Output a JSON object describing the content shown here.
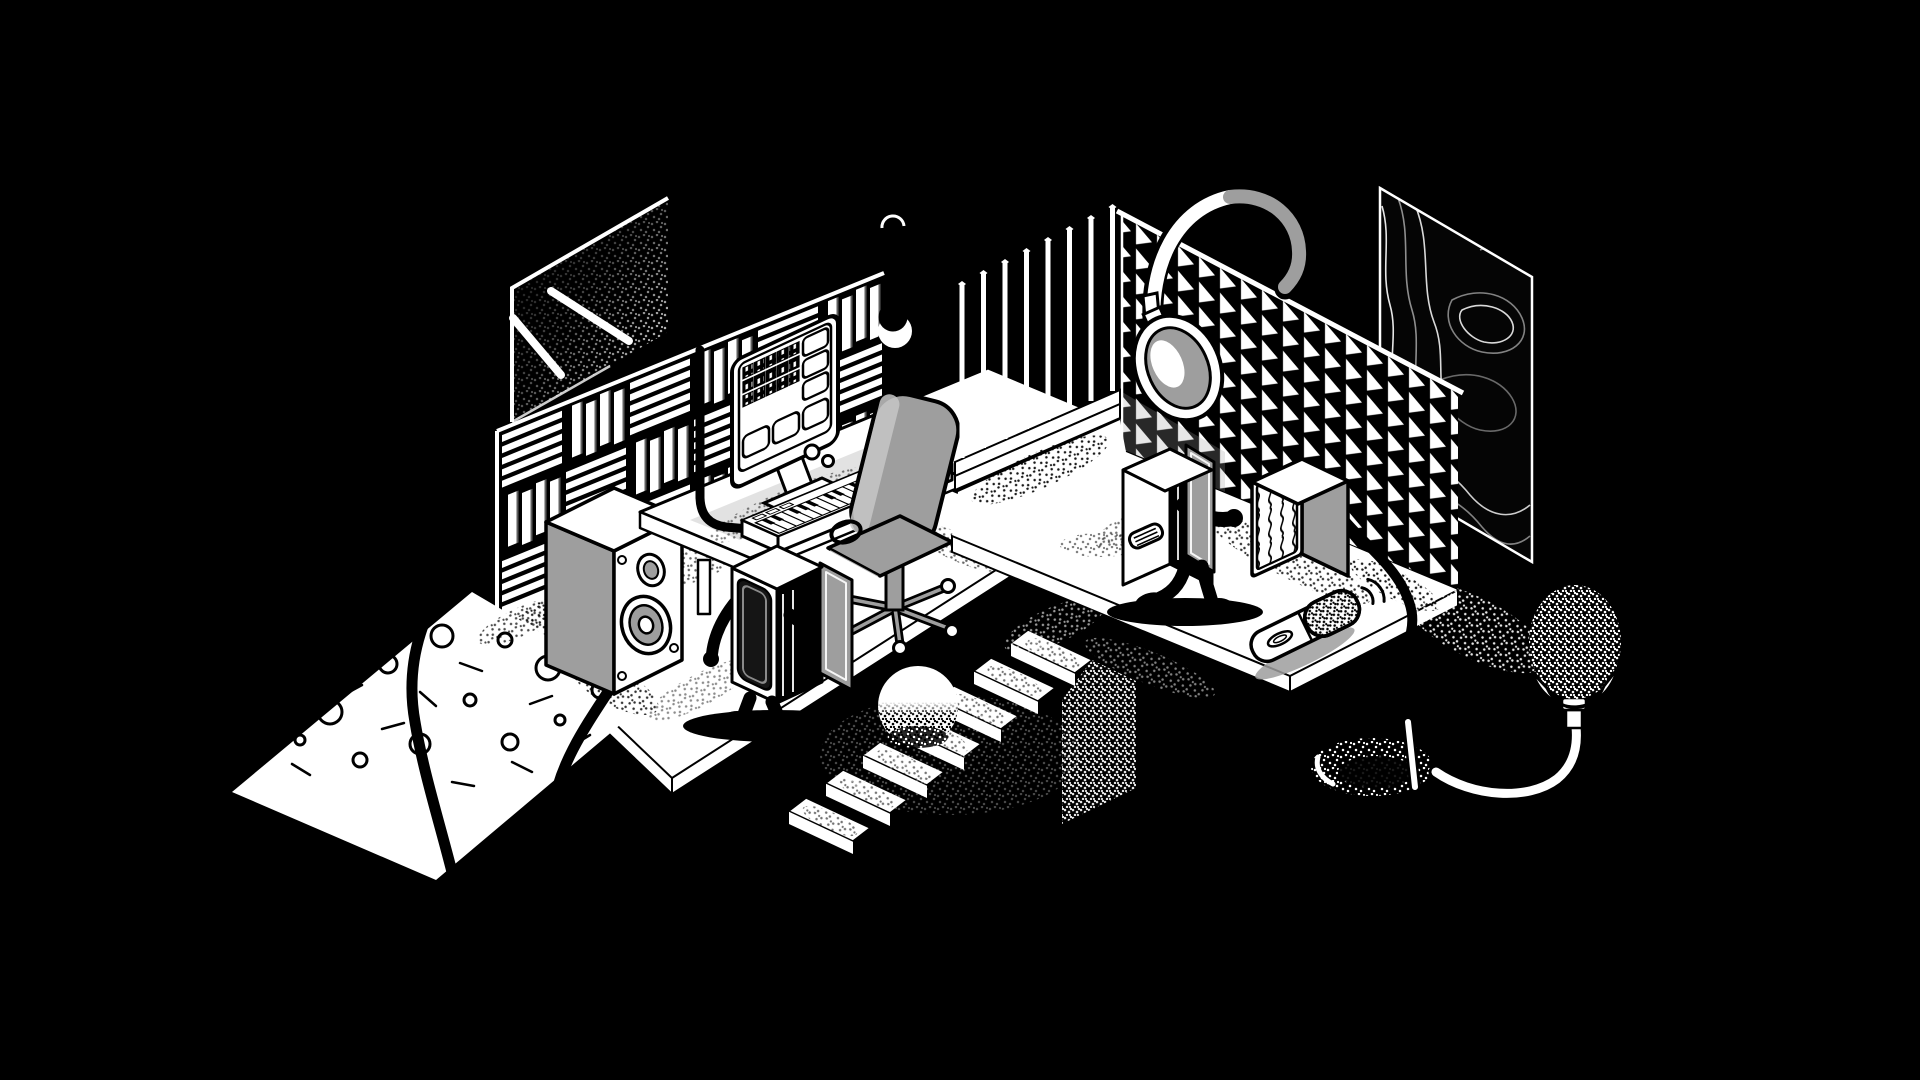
{
  "scene": {
    "description": "Monochrome isometric illustration of a two-room music studio: on the left a mixing room with a window, slatted acoustic wall, desk with computer monitor showing a DAW session, MIDI keyboard, office chair, a large studio monitor speaker and a walking cabinet character; between the rooms a hanging eclipse orb and a staircase with a ball; on the right a vocal booth with vertical rod diffuser, triangular acoustic foam wall, hanging headphones, a topographic art panel, a walking fridge character, a bass-trap cube, a handheld microphone, and a pop-filter microphone on a gooseneck rising from a hole in the floor.",
    "style": "black and white isometric line art with stipple shading"
  },
  "palette": {
    "background": "#000000",
    "ink": "#000000",
    "paper": "#ffffff",
    "gray": "#9e9e9e",
    "gray_light": "#c6c6c6"
  },
  "objects": [
    {
      "id": "window",
      "kind": "window with light beams"
    },
    {
      "id": "slat-acoustic-wall",
      "kind": "acoustic slat wall"
    },
    {
      "id": "pendant-orb",
      "kind": "eclipse orb lamp"
    },
    {
      "id": "desk",
      "kind": "studio desk"
    },
    {
      "id": "monitor",
      "kind": "computer monitor with session blocks"
    },
    {
      "id": "midi-keyboard",
      "kind": "MIDI keyboard"
    },
    {
      "id": "office-chair",
      "kind": "office chair"
    },
    {
      "id": "studio-speaker",
      "kind": "studio monitor speaker"
    },
    {
      "id": "cabinet-robot",
      "kind": "walking cabinet character"
    },
    {
      "id": "terrazzo-floor",
      "kind": "dotted floor patch"
    },
    {
      "id": "cables",
      "kind": "audio cables"
    },
    {
      "id": "staircase",
      "kind": "stairs"
    },
    {
      "id": "ball",
      "kind": "sphere on stairs"
    },
    {
      "id": "diffuser-rods",
      "kind": "vertical rod diffuser"
    },
    {
      "id": "foam-wall",
      "kind": "triangular acoustic foam wall"
    },
    {
      "id": "headphones",
      "kind": "studio headphones"
    },
    {
      "id": "topo-panel",
      "kind": "topographic art panel"
    },
    {
      "id": "booth-floor",
      "kind": "vocal booth floor"
    },
    {
      "id": "fridge-robot",
      "kind": "walking fridge character"
    },
    {
      "id": "bass-trap",
      "kind": "bass trap cube"
    },
    {
      "id": "microphone",
      "kind": "handheld microphone"
    },
    {
      "id": "sound-waves",
      "kind": "sound wave marks"
    },
    {
      "id": "floor-hole",
      "kind": "hole in the floor"
    },
    {
      "id": "pop-filter",
      "kind": "pop filter mic on gooseneck"
    }
  ]
}
